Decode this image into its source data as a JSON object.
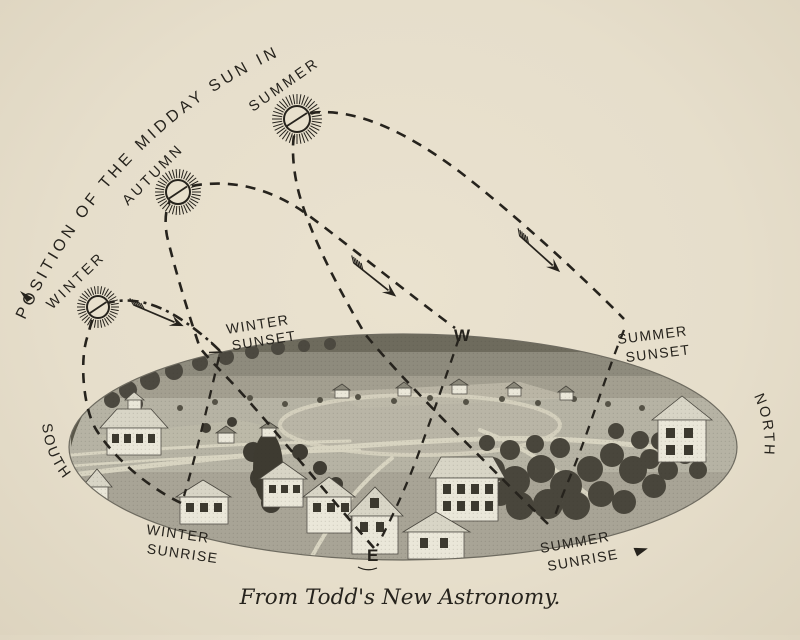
{
  "figure": {
    "title_curved": "POSITION OF THE MIDDAY SUN IN",
    "seasons": {
      "winter": "WINTER",
      "autumn": "AUTUMN",
      "summer": "SUMMER"
    },
    "compass": {
      "west": "W",
      "east": "E",
      "south": "SOUTH",
      "north": "NORTH"
    },
    "horizon_labels": {
      "winter_sunset": [
        "WINTER",
        "SUNSET"
      ],
      "summer_sunset": [
        "SUMMER",
        "SUNSET"
      ],
      "winter_sunrise": [
        "WINTER",
        "SUNRISE"
      ],
      "summer_sunrise": [
        "SUMMER",
        "SUNRISE"
      ]
    },
    "caption": "From Todd's New Astronomy.",
    "colors": {
      "paper": "#e8e0cd",
      "ink": "#26231d"
    },
    "icons": {
      "sun": "sun-symbol-with-rays",
      "arrow": "feathered-direction-arrow"
    }
  }
}
